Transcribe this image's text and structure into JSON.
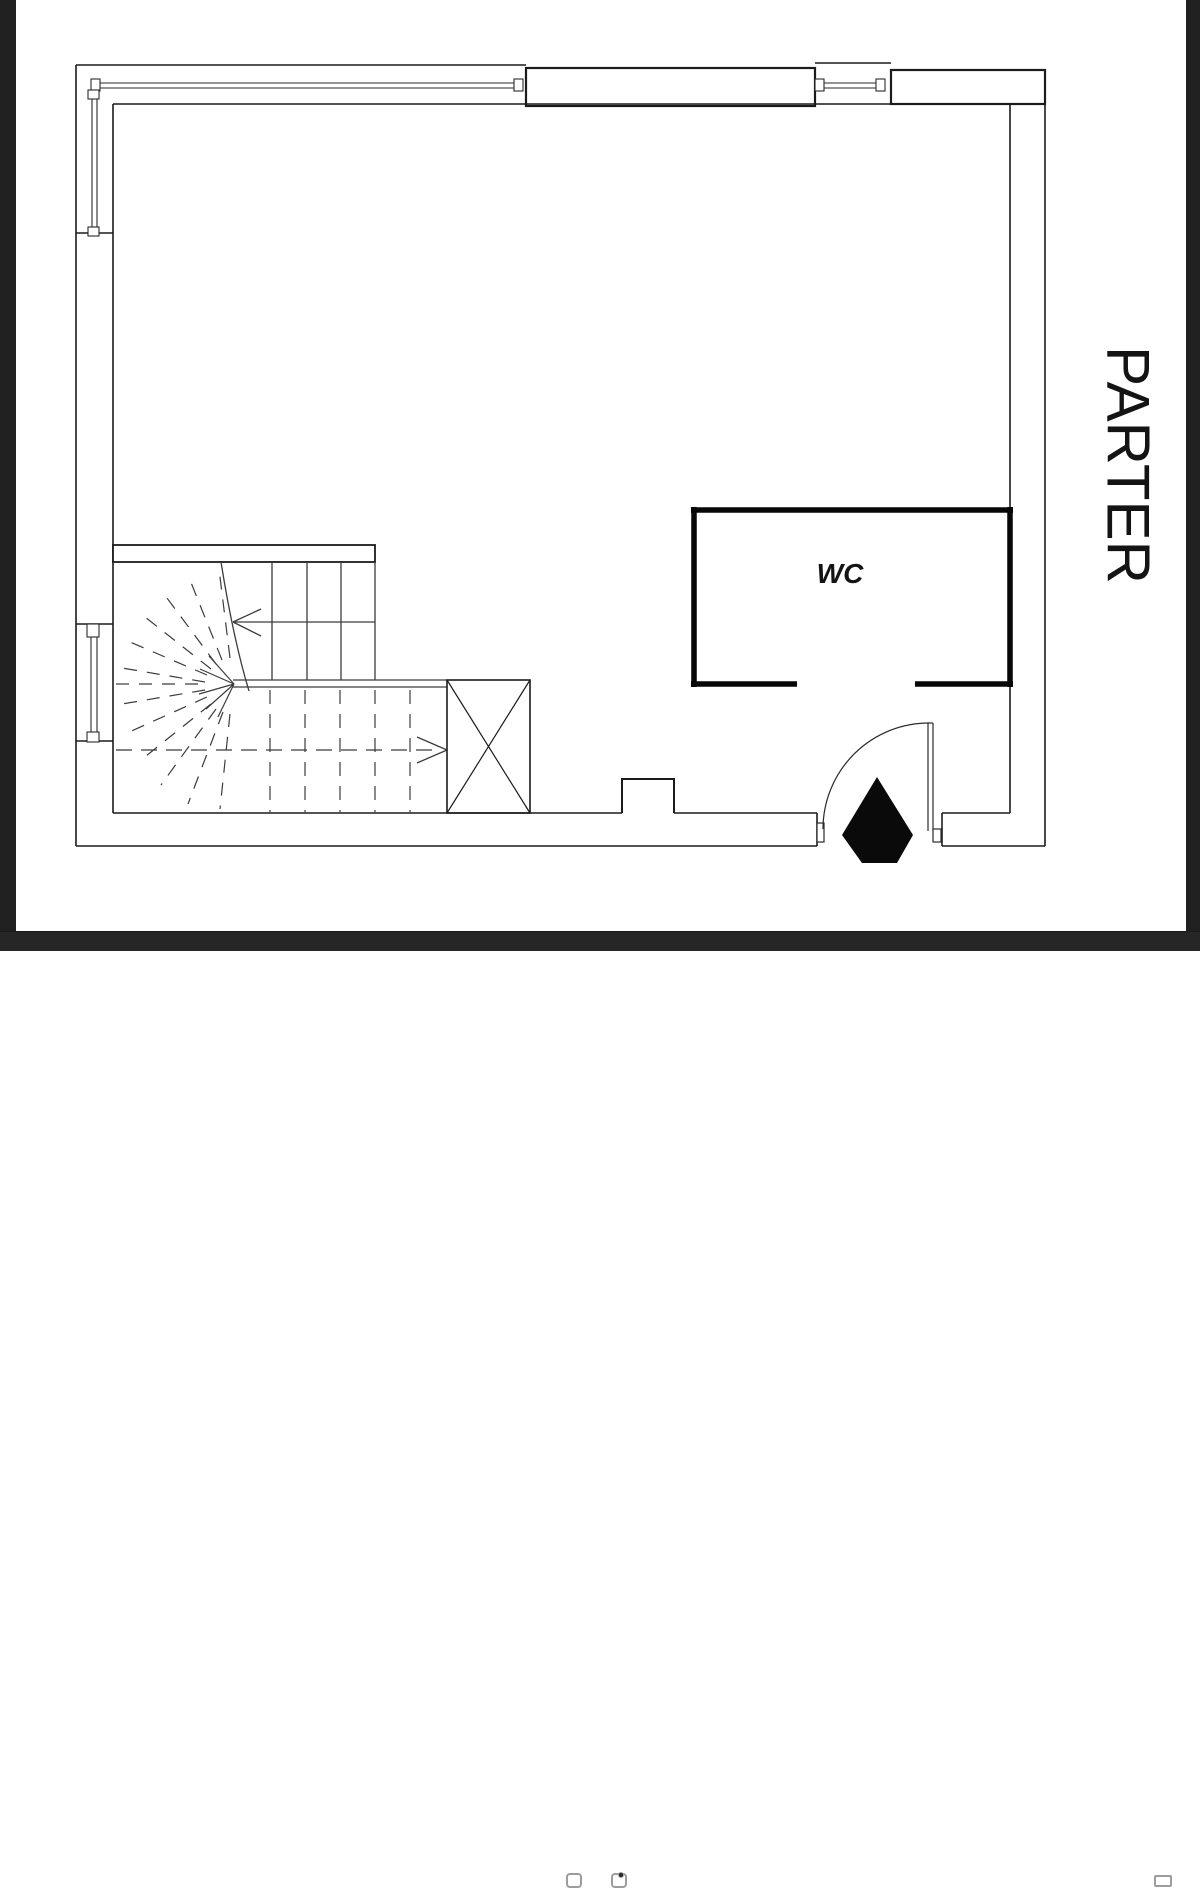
{
  "viewer": {
    "background": "#ffffff",
    "frame_color": "#212121",
    "toolbar_color": "#262626",
    "toolbar_icon_color": "#9c9c9c"
  },
  "plan": {
    "title": "PARTER",
    "wc_label": "WC",
    "wall_color": "#1b1b1b",
    "wc_wall_color": "#070707",
    "stair_line_color": "#3c3c3c",
    "entrance_marker_color": "#0a0a0a"
  },
  "toolbar": {
    "icons": [
      {
        "name": "rounded-square-icon"
      },
      {
        "name": "camera-icon"
      },
      {
        "name": "image-frame-icon"
      }
    ]
  }
}
